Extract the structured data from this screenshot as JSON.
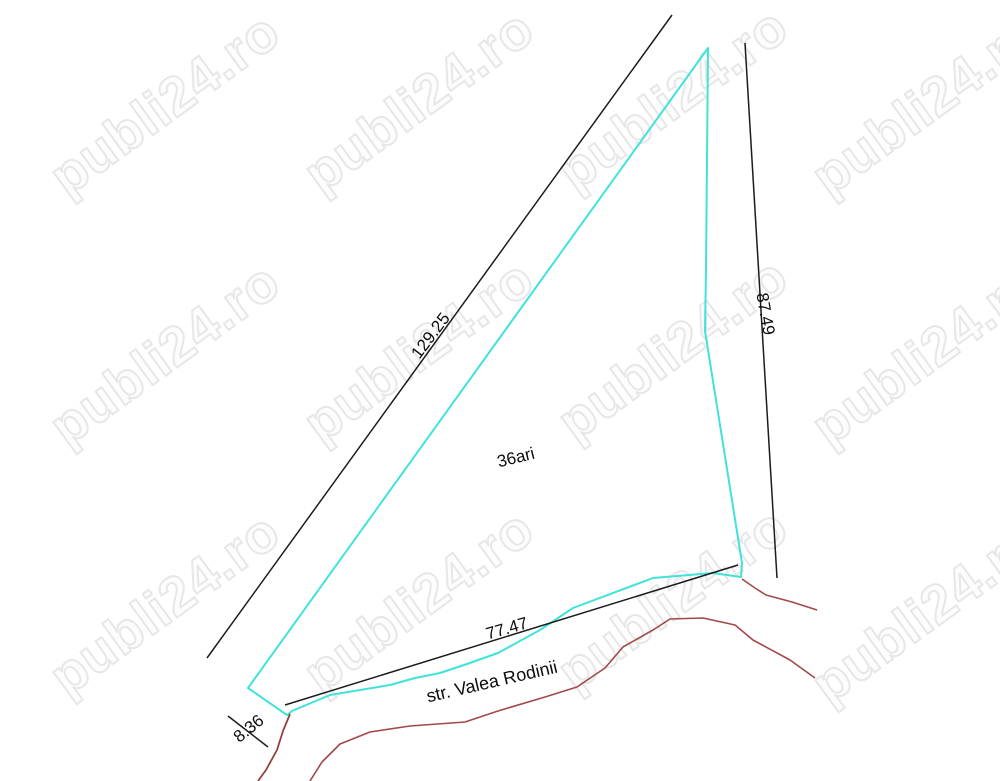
{
  "watermark": {
    "text": "publi24.ro"
  },
  "parcel": {
    "area_label": "36ari",
    "dimensions": {
      "long_side": "129.25",
      "right_side": "87.49",
      "bottom_side": "77.47",
      "small_side": "8.36"
    }
  },
  "street": {
    "name": "str. Valea Rodinii"
  },
  "colors": {
    "parcel_outline": "#3fe3da",
    "dimension_line": "#1c1c1c",
    "road_line": "#a2484a",
    "road_line_dark": "#93413e",
    "watermark_outline": "#e7e7e7"
  }
}
